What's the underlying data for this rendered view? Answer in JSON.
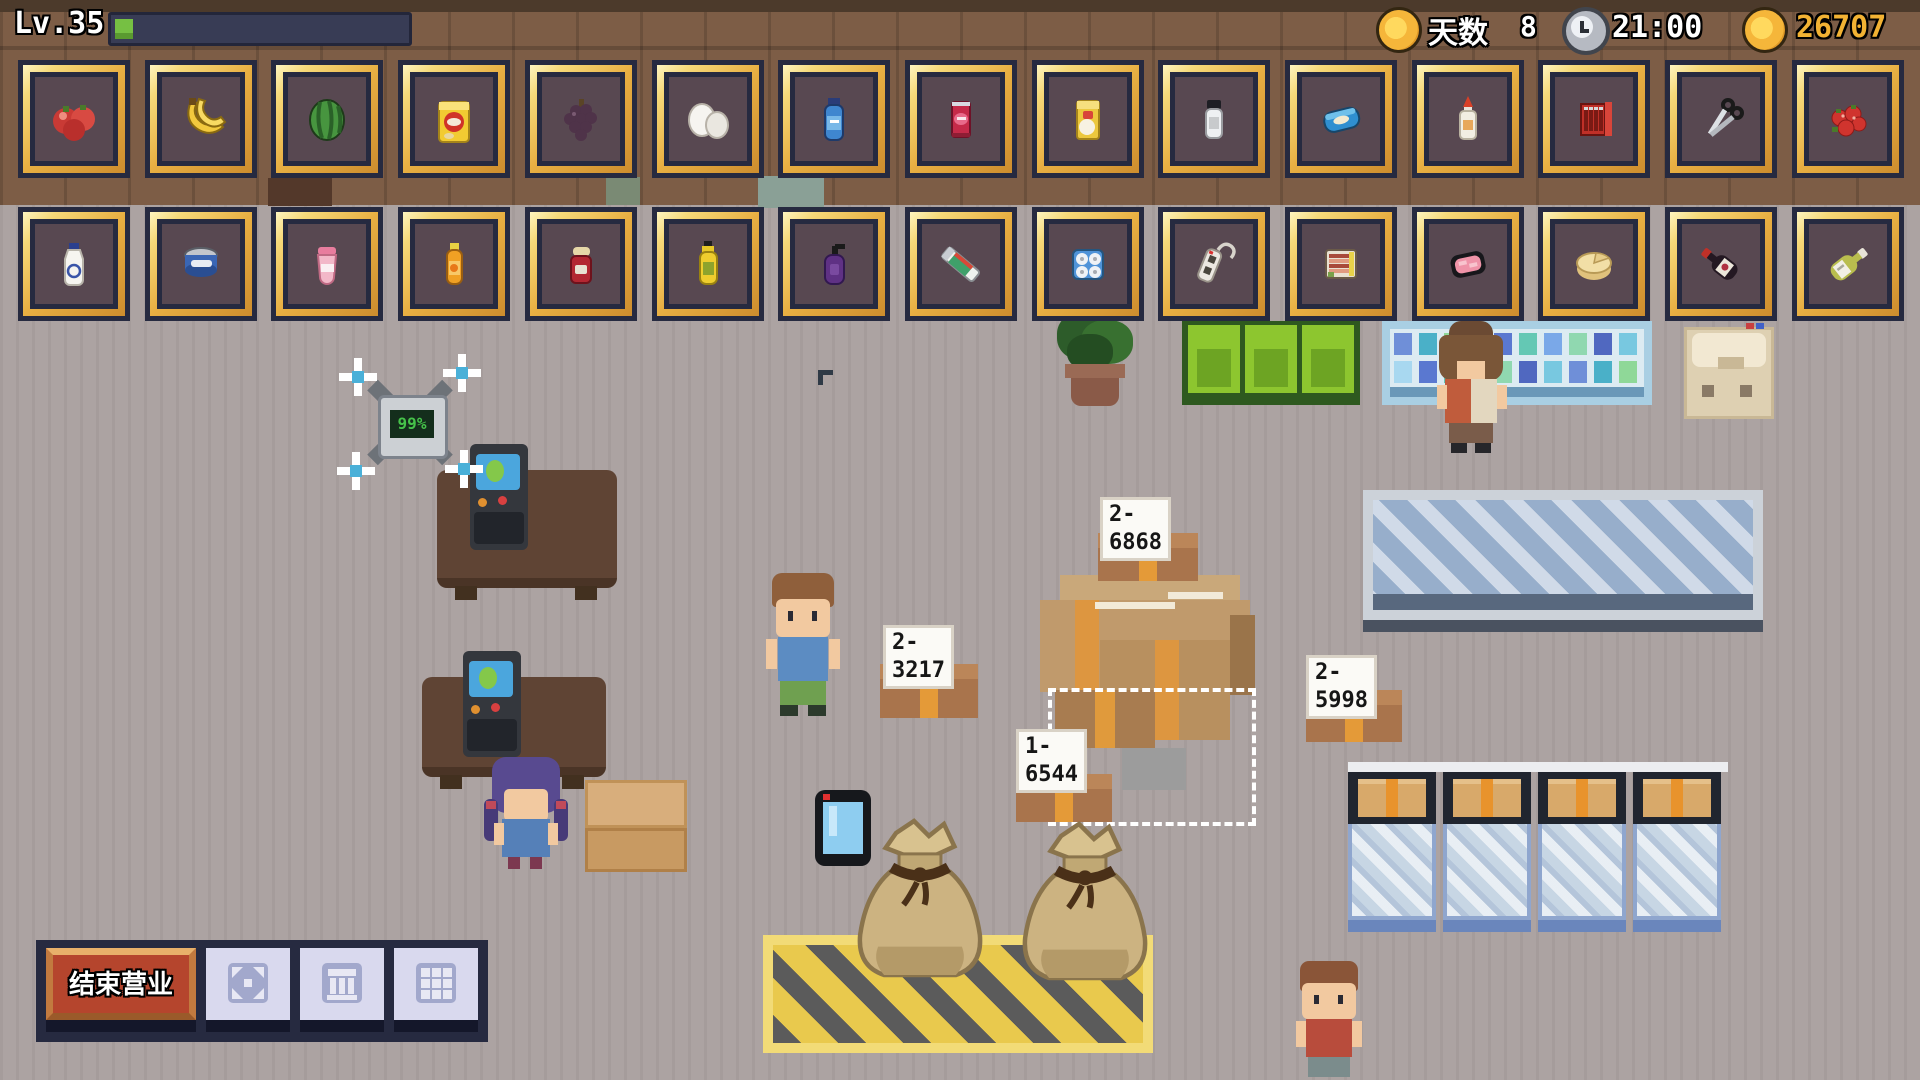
{
  "hud": {
    "level": "Lv.35",
    "xp_percent": 6,
    "day_icon": "coin-icon",
    "day_label": "天数",
    "day_value": "8",
    "time_icon": "clock-icon",
    "time": "21:00",
    "money_icon": "coin-icon",
    "money": "26707",
    "colors": {
      "money_text": "#f2b233",
      "xp_green": "#76c043"
    }
  },
  "inventory": {
    "row1": [
      "tomatoes",
      "bananas",
      "watermelon",
      "potato-chips",
      "grapes",
      "eggs",
      "water-bottle",
      "cola-can",
      "flour-bag",
      "salt-shaker",
      "wet-wipes",
      "glue-bottle",
      "batteries",
      "scissors",
      "strawberries"
    ],
    "row2": [
      "milk-bottle",
      "tuna-can",
      "yogurt-cup",
      "orange-juice-bottle",
      "jam-jar",
      "cooking-oil",
      "shampoo",
      "toothpaste",
      "toilet-paper-pack",
      "power-strip",
      "bacon-pack",
      "meat-tray",
      "cheese-wheel",
      "red-wine-bottle",
      "white-wine-bottle"
    ]
  },
  "scene": {
    "drone_battery": "99%",
    "shipment_boxes": [
      {
        "label": "2-6868"
      },
      {
        "label": "2-3217"
      },
      {
        "label": "2-5998"
      },
      {
        "label": "1-6544"
      }
    ]
  },
  "toolbar": {
    "end_business_label": "结束营业",
    "icon_buttons": [
      "expand-icon",
      "bank-icon",
      "grid-icon"
    ],
    "colors": {
      "end_business_red": "#b5452d",
      "slot_gold": "#e8b64c"
    }
  }
}
